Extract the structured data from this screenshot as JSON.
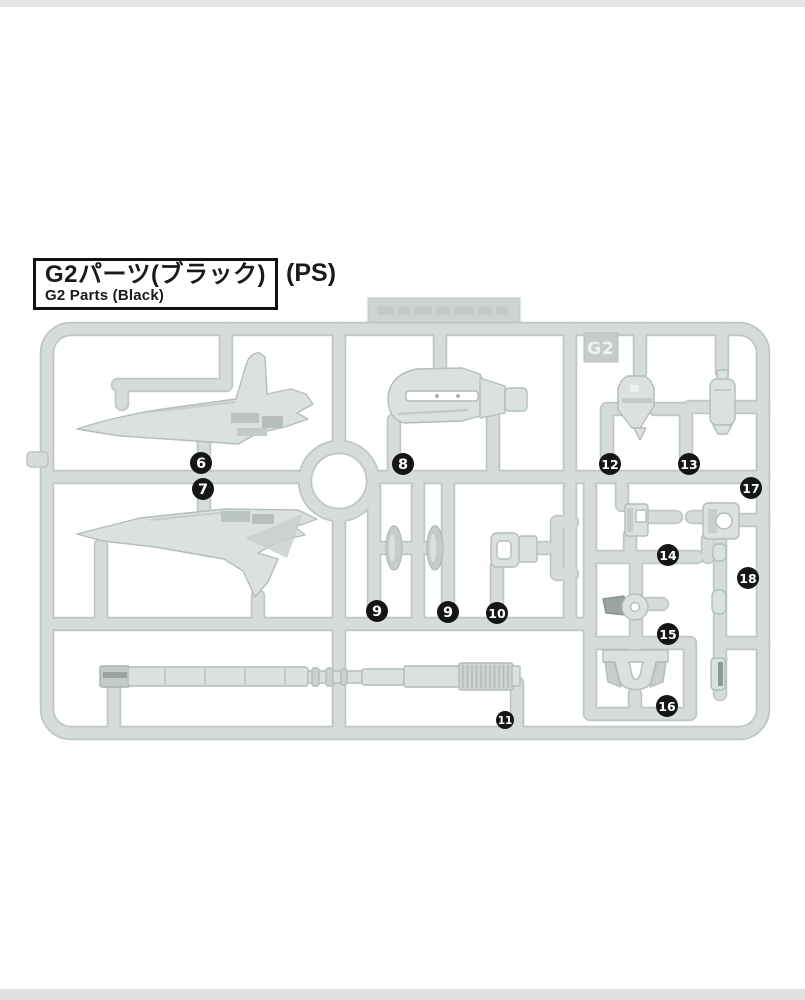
{
  "page": {
    "title_jp": "G2パーツ(ブラック)",
    "material_label": "(PS)",
    "title_en": "G2 Parts (Black)"
  },
  "runner": {
    "code": "G2",
    "part_numbers": [
      "6",
      "7",
      "8",
      "9",
      "9",
      "10",
      "11",
      "12",
      "13",
      "14",
      "15",
      "16",
      "17",
      "18"
    ],
    "badges": [
      {
        "n": "6",
        "x": 201,
        "y": 463
      },
      {
        "n": "7",
        "x": 203,
        "y": 489
      },
      {
        "n": "8",
        "x": 403,
        "y": 464
      },
      {
        "n": "9",
        "x": 377,
        "y": 611
      },
      {
        "n": "9",
        "x": 448,
        "y": 612
      },
      {
        "n": "10",
        "x": 497,
        "y": 613
      },
      {
        "n": "11",
        "x": 505,
        "y": 720,
        "r": 9
      },
      {
        "n": "12",
        "x": 610,
        "y": 464
      },
      {
        "n": "13",
        "x": 689,
        "y": 464
      },
      {
        "n": "14",
        "x": 668,
        "y": 555
      },
      {
        "n": "15",
        "x": 668,
        "y": 634
      },
      {
        "n": "16",
        "x": 667,
        "y": 706
      },
      {
        "n": "17",
        "x": 751,
        "y": 488
      },
      {
        "n": "18",
        "x": 748,
        "y": 578
      }
    ]
  },
  "colors": {
    "rail_outline": "#bfc6c6",
    "rail_fill": "#d6dbdb",
    "part_fill": "#dbe0e0",
    "part_outline": "#b4bcbc",
    "part_shade": "#c3caca",
    "badge_bg": "#151515",
    "badge_text": "#ffffff",
    "tag_bg": "#c6cccc",
    "tag_text": "#eef1f1",
    "tab_bg": "#cdd3d3"
  }
}
